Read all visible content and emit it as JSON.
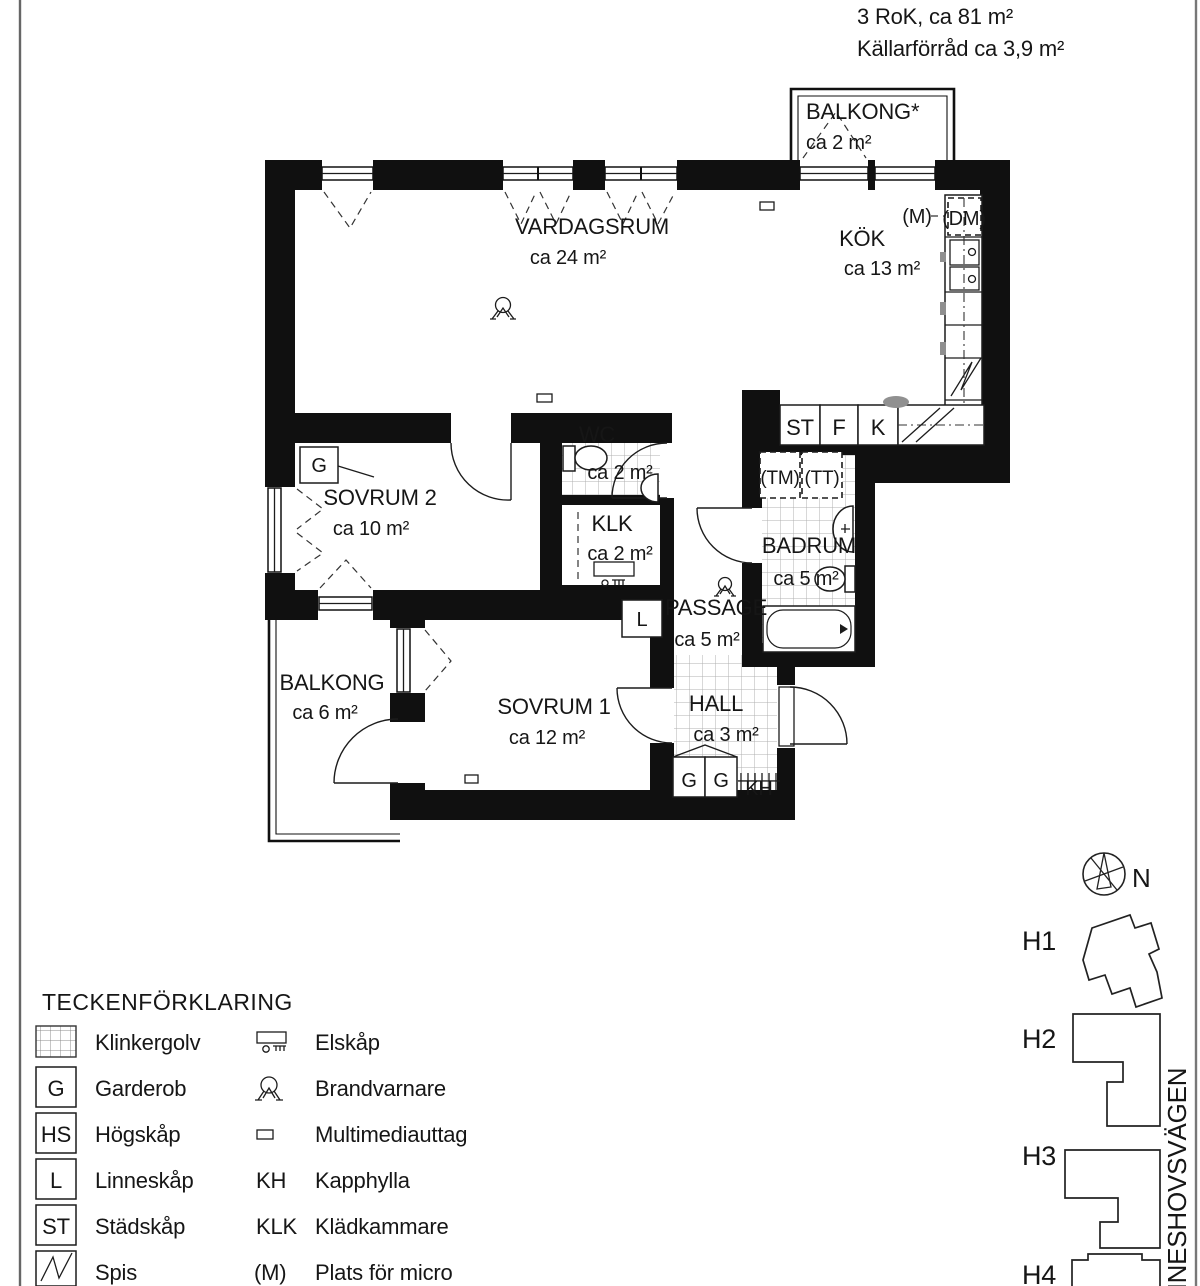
{
  "title": {
    "line1": "3  RoK, ca 81 m²",
    "line2": "Källarförråd ca 3,9 m²"
  },
  "rooms": {
    "balkong_top": {
      "name": "BALKONG*",
      "area": "ca 2 m²"
    },
    "vardagsrum": {
      "name": "VARDAGSRUM",
      "area": "ca 24 m²"
    },
    "kok": {
      "name": "KÖK",
      "area": "ca 13 m²"
    },
    "sovrum2": {
      "name": "SOVRUM 2",
      "area": "ca 10 m²"
    },
    "wc": {
      "name": "WC",
      "area": "ca 2 m²"
    },
    "klk": {
      "name": "KLK",
      "area": "ca 2 m²"
    },
    "badrum": {
      "name": "BADRUM",
      "area": "ca 5 m²"
    },
    "passage": {
      "name": "PASSAGE",
      "area": "ca 5 m²"
    },
    "sovrum1": {
      "name": "SOVRUM 1",
      "area": "ca 12 m²"
    },
    "hall": {
      "name": "HALL",
      "area": "ca 3 m²"
    },
    "balkong": {
      "name": "BALKONG",
      "area": "ca 6 m²"
    }
  },
  "fixtures": {
    "g": "G",
    "l": "L",
    "kh": "KH",
    "st": "ST",
    "f": "F",
    "k": "K",
    "m": "(M)",
    "dm": "(DM)",
    "tm": "(TM)",
    "tt": "(TT)"
  },
  "legend": {
    "heading": "TECKENFÖRKLARING",
    "col1": [
      {
        "abbr": "",
        "label": "Klinkergolv"
      },
      {
        "abbr": "G",
        "label": "Garderob"
      },
      {
        "abbr": "HS",
        "label": "Högskåp"
      },
      {
        "abbr": "L",
        "label": "Linneskåp"
      },
      {
        "abbr": "ST",
        "label": "Städskåp"
      },
      {
        "abbr": "",
        "label": "Spis"
      }
    ],
    "col2": [
      {
        "abbr": "",
        "label": "Elskåp"
      },
      {
        "abbr": "",
        "label": "Brandvarnare"
      },
      {
        "abbr": "",
        "label": "Multimediauttag"
      },
      {
        "abbr": "KH",
        "label": "Kapphylla"
      },
      {
        "abbr": "KLK",
        "label": "Klädkammare"
      },
      {
        "abbr": "(M)",
        "label": "Plats för micro"
      }
    ]
  },
  "siteplan": {
    "north": "N",
    "buildings": [
      "H1",
      "H2",
      "H3",
      "H4"
    ],
    "street": "NNESHOVSVÄGEN"
  },
  "colors": {
    "wall": "#101010",
    "tile_line": "#b0b0b0",
    "border_line": "#666666"
  }
}
